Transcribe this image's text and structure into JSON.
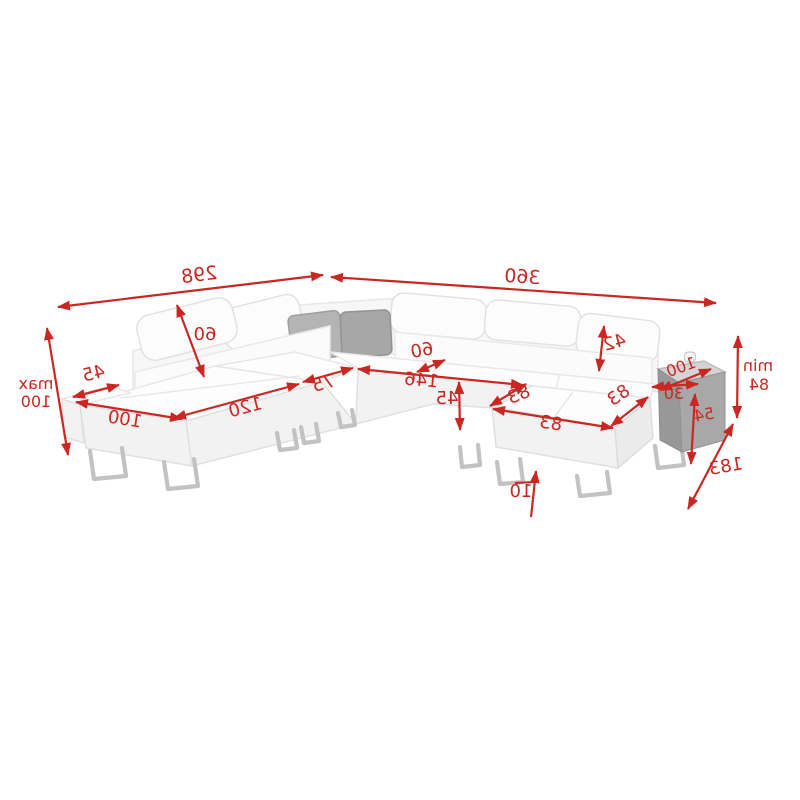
{
  "accent_color": "#cb2722",
  "sofa_color": "#ffffff",
  "dims": {
    "total_width_left": "298",
    "total_width_right": "360",
    "max_height_prefix": "max",
    "max_height_value": "100",
    "armrest_width": "45",
    "chaise_front_length": "100",
    "seat_section_length": "120",
    "headrest_diagonal": "60",
    "corner_section_width": "75",
    "seat_depth_offset": "60",
    "bed_length": "146",
    "seat_height": "45",
    "ottoman_diag_left": "83",
    "ottoman_diag_right": "83",
    "ottoman_front_length": "83",
    "headrest_height": "42",
    "table_depth": "100",
    "table_width": "30",
    "table_height": "54",
    "min_height_prefix": "min",
    "min_height_value": "84",
    "total_depth": "183",
    "floor_clearance": "10"
  }
}
